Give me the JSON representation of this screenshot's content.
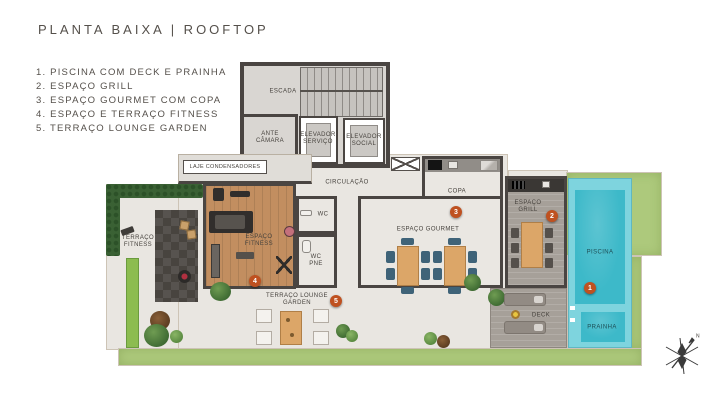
{
  "page": {
    "title": "PLANTA BAIXA | ROOFTOP"
  },
  "legend": {
    "items": [
      "1. PISCINA COM DECK E PRAINHA",
      "2. ESPAÇO GRILL",
      "3. ESPAÇO GOURMET COM COPA",
      "4. ESPAÇO E TERRAÇO FITNESS",
      "5. TERRAÇO LOUNGE GARDEN"
    ]
  },
  "plan": {
    "labels": {
      "escada": "ESCADA",
      "ante_camara": "ANTE CÂMARA",
      "elevador_servico": "ELEVADOR SERVIÇO",
      "elevador_social": "ELEVADOR SOCIAL",
      "laje_condensadores": "LAJE CONDENSADORES",
      "circulacao": "CIRCULAÇÃO",
      "copa": "COPA",
      "wc": "WC",
      "wc_pne": "WC PNE",
      "espaco_fitness": "ESPAÇO FITNESS",
      "terraco_fitness": "TERRAÇO FITNESS",
      "espaco_gourmet": "ESPAÇO GOURMET",
      "espaco_grill": "ESPAÇO GRILL",
      "piscina": "PISCINA",
      "deck": "DECK",
      "prainha": "PRAINHA",
      "terraco_lounge_garden": "TERRAÇO LOUNGE GARDEN"
    },
    "markers": [
      "1",
      "2",
      "3",
      "4",
      "5"
    ],
    "compass": {
      "north_label": "N"
    },
    "colors": {
      "marker": "#bf5120",
      "water": "#3db9c9",
      "pool_tile": "#7ed4de",
      "grass": "#adc97c",
      "hedge": "#3a6134",
      "wood_floor": "#c28e60",
      "deck_wood": "#a6a099",
      "wall": "#4a4542"
    }
  }
}
